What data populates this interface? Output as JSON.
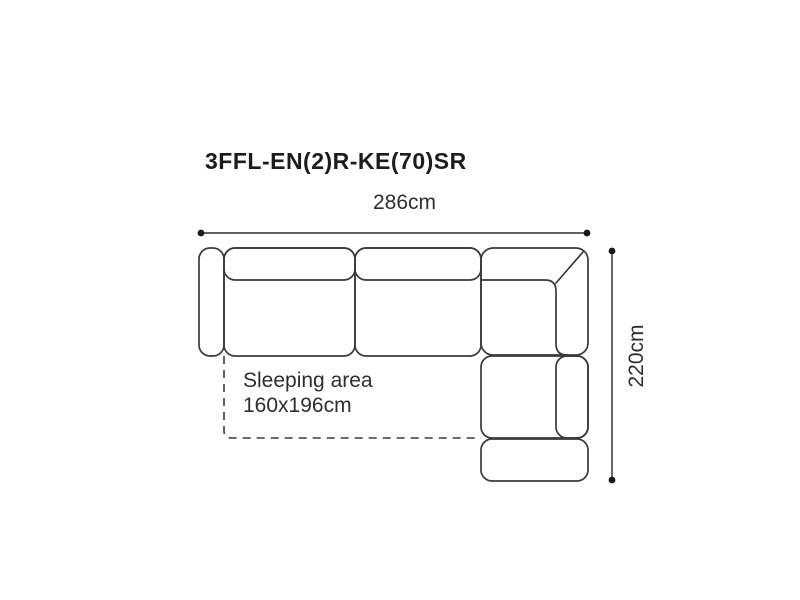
{
  "product": {
    "code": "3FFL-EN(2)R-KE(70)SR"
  },
  "dimensions": {
    "width_label": "286cm",
    "height_label": "220cm"
  },
  "sleeping_area": {
    "label": "Sleeping area",
    "size": "160x196cm"
  },
  "diagram": {
    "type": "sofa-top-view",
    "modules": [
      "left-armrest",
      "seat-section-1",
      "seat-section-2",
      "corner-section",
      "right-seat-section",
      "end-ottoman"
    ]
  },
  "colors": {
    "background": "#ffffff",
    "outline": "#3a3a3a",
    "dimension_line": "#2b2b2b",
    "text": "#2e2e2e",
    "title": "#1c1c1c"
  }
}
